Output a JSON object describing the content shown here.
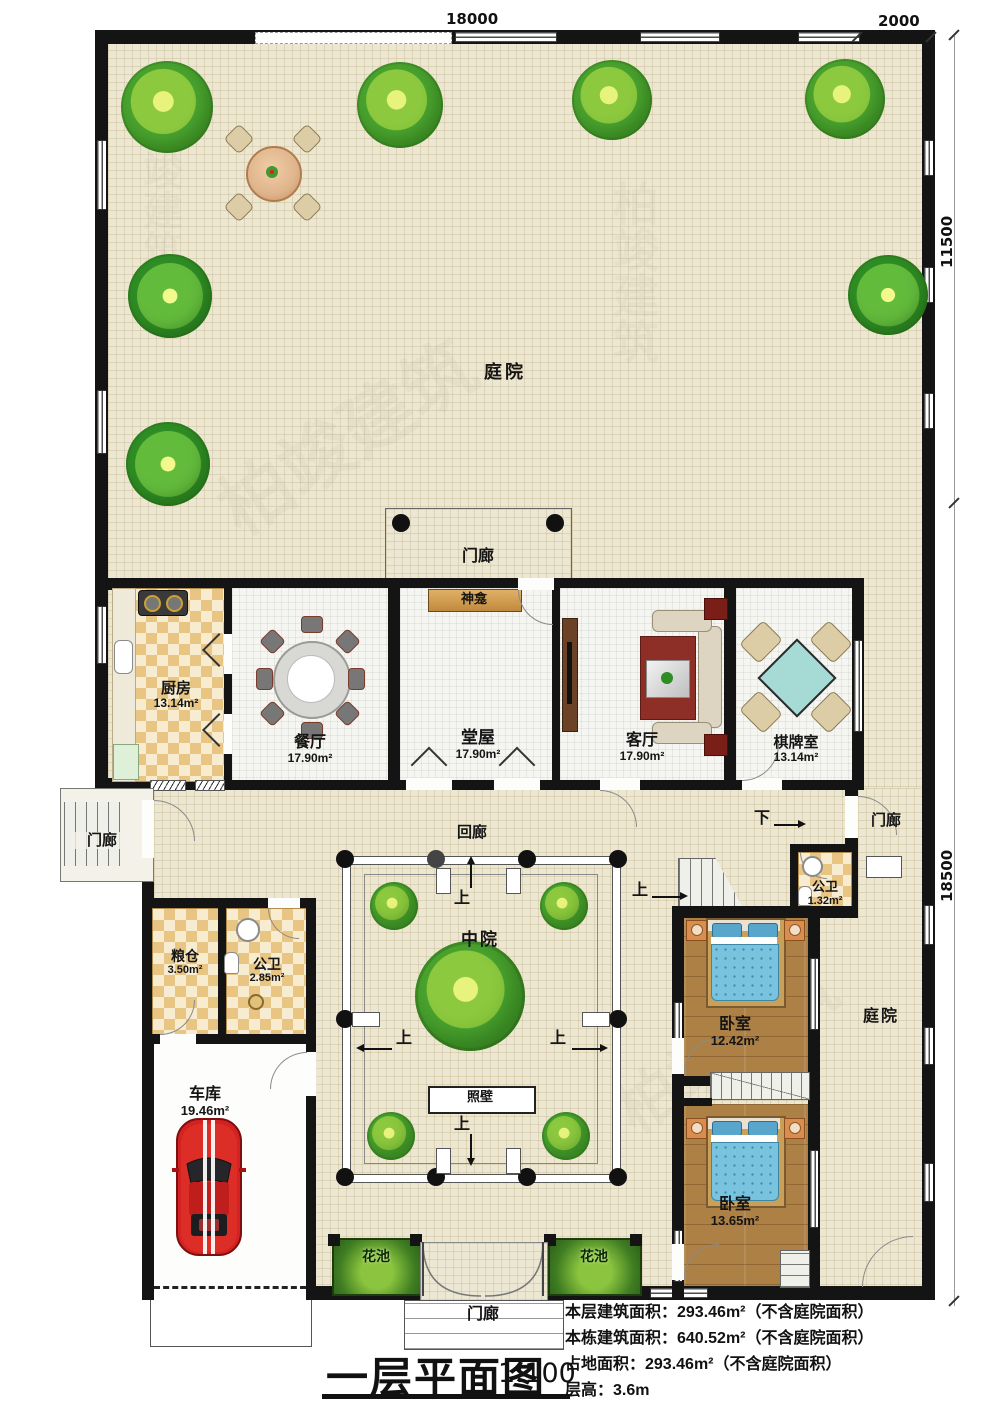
{
  "plan": {
    "title": "一层平面图",
    "scale": "1:100",
    "stats": {
      "line1": "本层建筑面积：293.46m²（不含庭院面积）",
      "line2": "本栋建筑面积：640.52m²（不含庭院面积）",
      "line3": "占地面积：293.46m²（不含庭院面积）",
      "line4": "层高：3.6m"
    }
  },
  "dimensions": {
    "top_width": "18000",
    "top_right_width": "2000",
    "right_upper_height": "11500",
    "right_lower_height": "18500"
  },
  "labels": {
    "courtyard": "庭院",
    "porch": "门廊",
    "cloister": "回廊",
    "middle_court": "中院",
    "screen_wall": "照壁",
    "shrine": "神龛",
    "flower_bed": "花池",
    "up": "上",
    "down": "下"
  },
  "rooms": {
    "kitchen": {
      "name": "厨房",
      "area": "13.14m²"
    },
    "dining": {
      "name": "餐厅",
      "area": "17.90m²"
    },
    "hall": {
      "name": "堂屋",
      "area": "17.90m²"
    },
    "living": {
      "name": "客厅",
      "area": "17.90m²"
    },
    "mahjong": {
      "name": "棋牌室",
      "area": "13.14m²"
    },
    "granary": {
      "name": "粮仓",
      "area": "3.50m²"
    },
    "bath_west": {
      "name": "公卫",
      "area": "2.85m²"
    },
    "bath_east": {
      "name": "公卫",
      "area": "1.32m²"
    },
    "garage": {
      "name": "车库",
      "area": "19.46m²"
    },
    "bedroom_north": {
      "name": "卧室",
      "area": "12.42m²"
    },
    "bedroom_south": {
      "name": "卧室",
      "area": "13.65m²"
    }
  },
  "watermark": {
    "brand": "柏竣建筑"
  }
}
